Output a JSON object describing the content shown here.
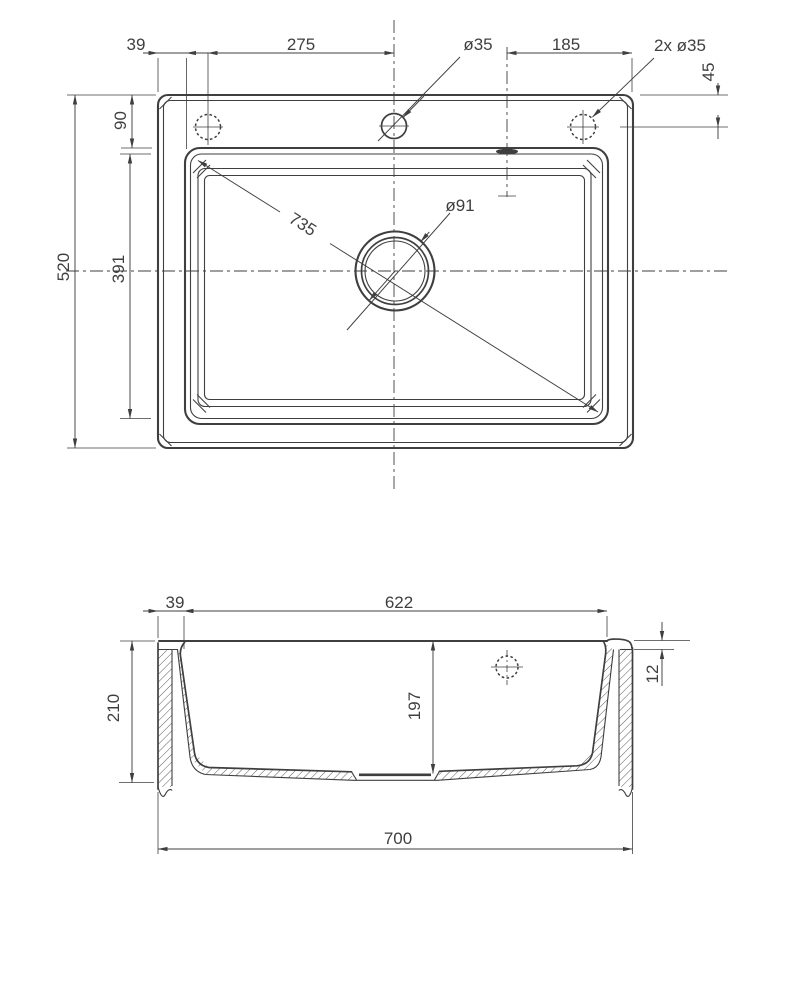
{
  "sheet": {
    "background": "#ffffff",
    "line_color": "#3f3f3f"
  },
  "top_view": {
    "dim_rim_offset": "39",
    "dim_hole_spacing": "275",
    "label_faucet_hole": "ø35",
    "dim_overflow_to_edge": "185",
    "label_side_holes": "2x ø35",
    "dim_hole_to_edge": "45",
    "dim_deck_depth": "90",
    "dim_overall_depth": "520",
    "dim_bowl_depth": "391",
    "dim_bowl_diagonal": "735",
    "label_drain_diameter": "ø91"
  },
  "section_view": {
    "dim_rim_offset": "39",
    "dim_bowl_width": "622",
    "dim_overall_height": "210",
    "dim_bowl_height": "197",
    "dim_rim_height": "12",
    "dim_overall_width": "700"
  }
}
